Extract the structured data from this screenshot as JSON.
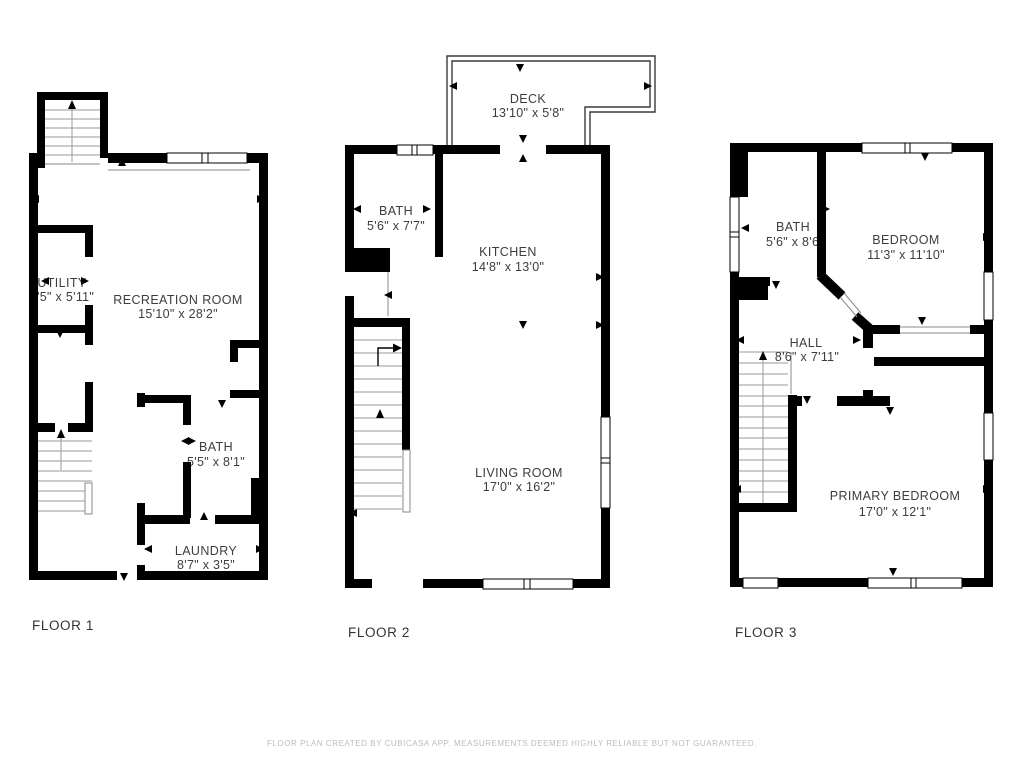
{
  "colors": {
    "wall": "#000000",
    "background": "#ffffff",
    "room_label": "#3d3d3d",
    "floor_label": "#333333",
    "footer_text": "#bcbcbc"
  },
  "floors": [
    {
      "label": "FLOOR 1",
      "rooms": [
        {
          "name": "UTILITY",
          "dims": "3'5\" x 5'11\""
        },
        {
          "name": "RECREATION ROOM",
          "dims": "15'10\" x 28'2\""
        },
        {
          "name": "BATH",
          "dims": "5'5\" x 8'1\""
        },
        {
          "name": "LAUNDRY",
          "dims": "8'7\" x 3'5\""
        }
      ]
    },
    {
      "label": "FLOOR 2",
      "rooms": [
        {
          "name": "DECK",
          "dims": "13'10\" x 5'8\""
        },
        {
          "name": "BATH",
          "dims": "5'6\" x 7'7\""
        },
        {
          "name": "KITCHEN",
          "dims": "14'8\" x 13'0\""
        },
        {
          "name": "LIVING ROOM",
          "dims": "17'0\" x 16'2\""
        }
      ]
    },
    {
      "label": "FLOOR 3",
      "rooms": [
        {
          "name": "BATH",
          "dims": "5'6\" x 8'6\""
        },
        {
          "name": "BEDROOM",
          "dims": "11'3\" x 11'10\""
        },
        {
          "name": "HALL",
          "dims": "8'6\" x 7'11\""
        },
        {
          "name": "PRIMARY BEDROOM",
          "dims": "17'0\" x 12'1\""
        }
      ]
    }
  ],
  "footer": {
    "disclaimer": "FLOOR PLAN CREATED BY CUBICASA APP. MEASUREMENTS DEEMED HIGHLY RELIABLE BUT NOT GUARANTEED."
  }
}
